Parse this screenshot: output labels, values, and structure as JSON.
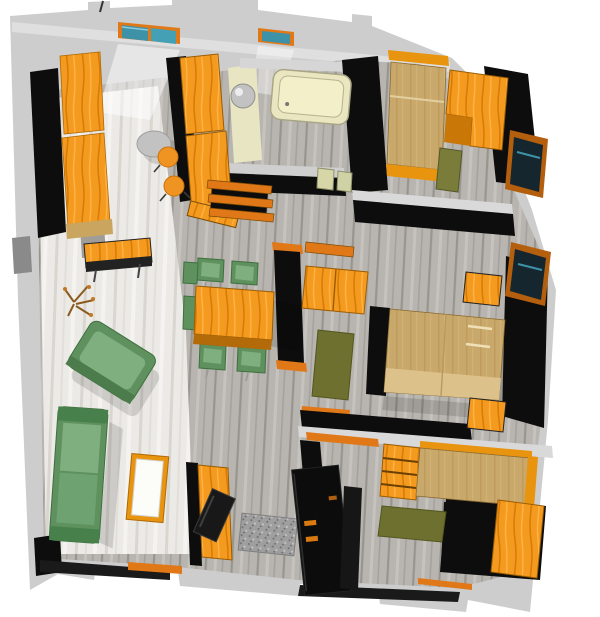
{
  "scene": {
    "title": "3D top-down rendering of an apartment floor plan",
    "view": "bird's-eye perspective, slightly rotated clockwise",
    "palette": {
      "background": "#ffffff",
      "outer_wall": "#cdcdcd",
      "outer_wall_light": "#dfdfdf",
      "inner_wall_black": "#0d0d0d",
      "wall_cap_light": "#d9d9d9",
      "cream_wall": "#e8e5c2",
      "floor_plank": "#b8b5b0",
      "floor_plank_streak": "#98958f",
      "floor_marble": "#eceae6",
      "floor_marble_streak": "#d9d6d0",
      "furniture_wood": "#f49a1e",
      "furniture_wood_streak": "#d87c08",
      "bed_tan": "#c9a96b",
      "bed_tan_light": "#dcc18a",
      "sofa_green": "#5f915f",
      "sofa_green_light": "#7fae7f",
      "sofa_green_dark": "#47804a",
      "rug_olive": "#6d702e",
      "window_teal": "#3e92a8",
      "window_frame_orange": "#e07818",
      "glass_dark": "#16262e",
      "door_black": "#0c0c0c",
      "metal_gray": "#c2c2c2",
      "doormat_gray": "#9f9f9f",
      "tub_cream": "#eae7c0"
    },
    "rooms": [
      {
        "name": "kitchen",
        "position": "top-left",
        "furniture": [
          "wall cabinets",
          "tall cabinet column",
          "wall-mounted table",
          "round table",
          "two stools",
          "diagonal shelf"
        ]
      },
      {
        "name": "bathroom",
        "position": "top-center",
        "furniture": [
          "bathtub",
          "spherical washbasin"
        ]
      },
      {
        "name": "bedroom-1",
        "position": "top-right",
        "furniture": [
          "single bed",
          "corner wardrobe desk",
          "olive chair"
        ]
      },
      {
        "name": "living-room",
        "position": "left",
        "furniture": [
          "tilted green armchair",
          "green sofa",
          "coffee table",
          "tv cabinet",
          "tv",
          "dry floor plant"
        ]
      },
      {
        "name": "dining-area",
        "position": "center",
        "furniture": [
          "wooden dining table",
          "six green chairs"
        ]
      },
      {
        "name": "hallway",
        "position": "center",
        "furniture": [
          "slatted bench",
          "glass panels",
          "orange wall shelf"
        ]
      },
      {
        "name": "bedroom-2",
        "position": "middle-right",
        "furniture": [
          "double bed",
          "wardrobe",
          "two nightstands",
          "olive rug"
        ]
      },
      {
        "name": "bedroom-3",
        "position": "bottom-right",
        "furniture": [
          "single bed with shelf headboard",
          "wardrobe",
          "olive rug"
        ]
      },
      {
        "name": "entry",
        "position": "bottom-center",
        "furniture": [
          "open black entrance door",
          "speckled doormat"
        ]
      }
    ],
    "openings": {
      "top_wall_windows": 2,
      "right_wall_windows": 2,
      "bottom_wall_sills": 2
    }
  }
}
